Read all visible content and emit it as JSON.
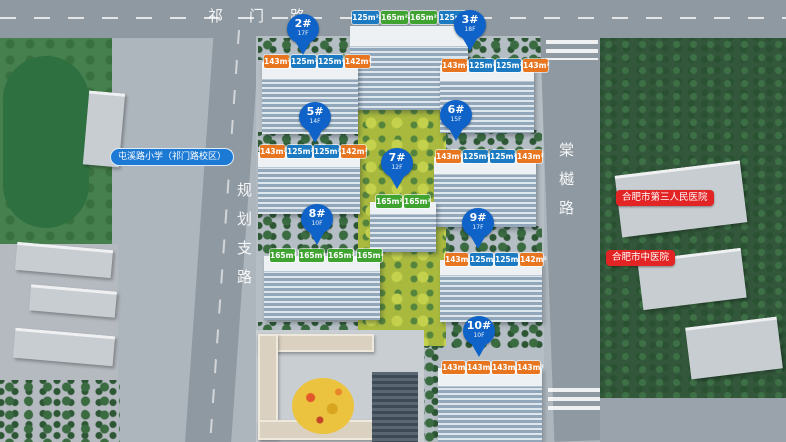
{
  "roads": {
    "top": "祁门路",
    "left": "规划支路",
    "right": "棠樾路"
  },
  "pois": {
    "school": "屯溪路小学（祁门路校区）",
    "hospital_third": "合肥市第三人民医院",
    "hospital_tcm": "合肥市中医院"
  },
  "colors": {
    "area_orange": "#e8751f",
    "area_blue": "#1b7ac2",
    "area_green": "#3fa32f",
    "pin_blue": "#0f63c8",
    "poi_red": "#e32424",
    "poi_school_blue": "#1d7ad4"
  },
  "pins": {
    "p2": {
      "label": "2#",
      "floors": "17F"
    },
    "p3": {
      "label": "3#",
      "floors": "18F"
    },
    "p5": {
      "label": "5#",
      "floors": "14F"
    },
    "p6": {
      "label": "6#",
      "floors": "15F"
    },
    "p7": {
      "label": "7#",
      "floors": "12F"
    },
    "p8": {
      "label": "8#",
      "floors": "10F"
    },
    "p9": {
      "label": "9#",
      "floors": "17F"
    },
    "p10": {
      "label": "10#",
      "floors": "10F"
    }
  },
  "area_labels": {
    "btop": [
      "125m²",
      "165m²",
      "165m²",
      "125m²"
    ],
    "b2": [
      "143m²",
      "125m²",
      "125m²",
      "142m²"
    ],
    "b3": [
      "143m²",
      "125m²",
      "125m²",
      "143m²"
    ],
    "b5": [
      "143m²",
      "125m²",
      "125m²",
      "142m²"
    ],
    "b6": [
      "143m²",
      "125m²",
      "125m²",
      "143m²"
    ],
    "b7": [
      "165m²",
      "165m²"
    ],
    "b8": [
      "165m²",
      "165m²",
      "165m²",
      "165m²"
    ],
    "b9": [
      "143m²",
      "125m²",
      "125m²",
      "142m²"
    ],
    "b10": [
      "143m²",
      "143m²",
      "143m²",
      "143m²"
    ]
  }
}
